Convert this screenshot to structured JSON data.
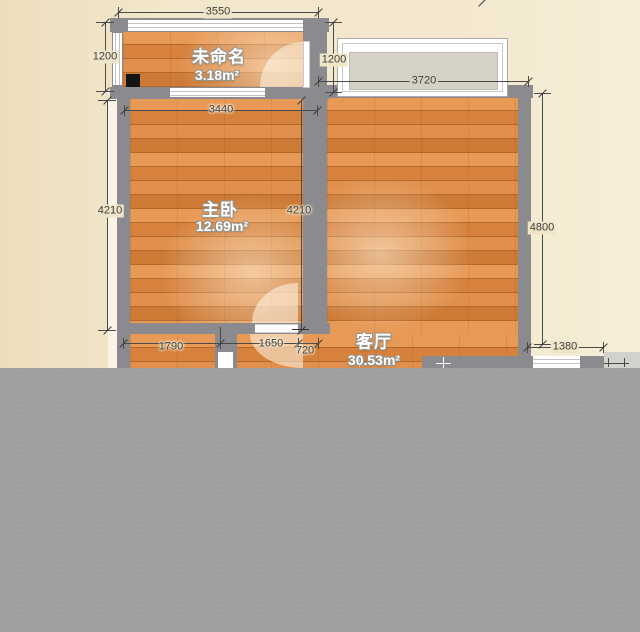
{
  "rooms": [
    {
      "name": "未命名",
      "area": "3.18m²"
    },
    {
      "name": "主卧",
      "area": "12.69m²"
    },
    {
      "name": "客厅",
      "area": "30.53m²"
    }
  ],
  "dimensions": {
    "top_width": "3550",
    "upper_left_height": "1200",
    "bedroom_width": "3440",
    "bedroom_height_left": "4210",
    "bedroom_height_right": "4210",
    "balcony_height": "1200",
    "balcony_width": "3720",
    "living_height": "4800",
    "bottom_right_width": "1380",
    "bottom_width_1": "1790",
    "bottom_width_2": "1650",
    "bottom_width_3": "720"
  },
  "colors": {
    "background": "#f2e6cb",
    "wall": "#8b8b8f",
    "wood_floor": "#dc8a42",
    "balcony_panel": "#d5d1c5",
    "dimension_text": "#3e3e3e",
    "censor_block": "#9f9f9f"
  }
}
